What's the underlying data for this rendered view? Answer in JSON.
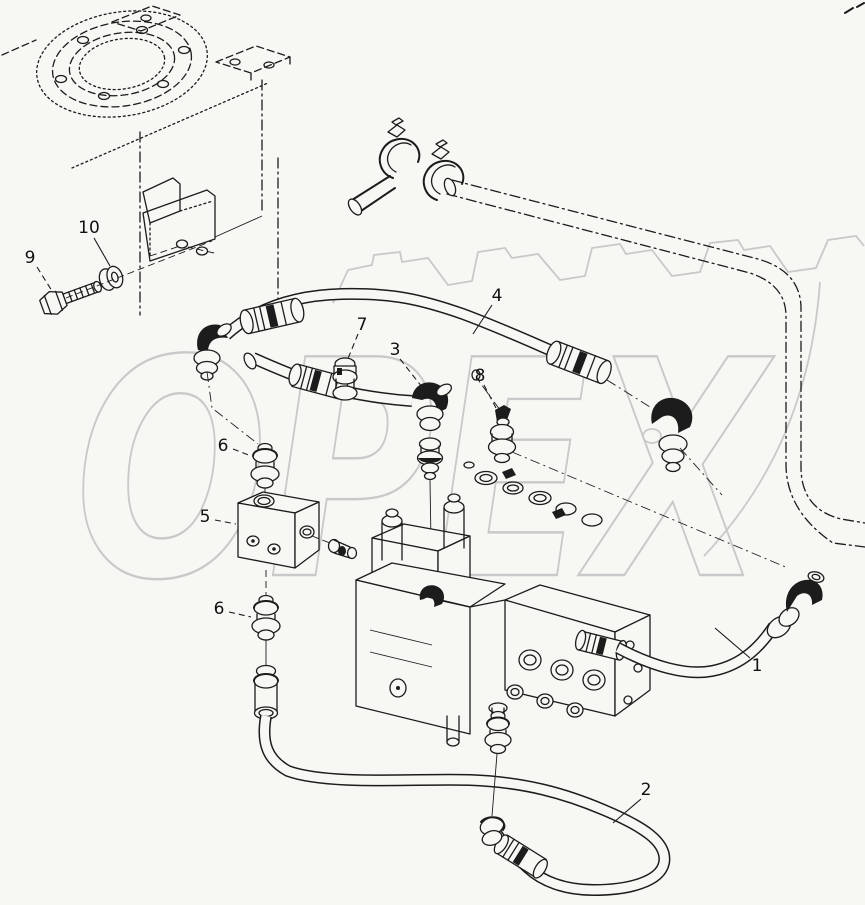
{
  "page": {
    "width": 865,
    "height": 905,
    "background": "#f7f7f4"
  },
  "diagram": {
    "type": "exploded-parts-diagram",
    "ink": "#1c1c1c",
    "watermark": {
      "text": "OPEX",
      "color": "#c9c9c9"
    },
    "callouts": [
      {
        "part": "9",
        "x": 30,
        "y": 258,
        "lx1": 37,
        "ly1": 267,
        "lx2": 52,
        "ly2": 291,
        "dash": true
      },
      {
        "part": "10",
        "x": 89,
        "y": 228,
        "lx1": 94,
        "ly1": 238,
        "lx2": 110,
        "ly2": 266,
        "dash": false
      },
      {
        "part": "4",
        "x": 497,
        "y": 296,
        "lx1": 492,
        "ly1": 305,
        "lx2": 473,
        "ly2": 334,
        "dash": false
      },
      {
        "part": "7",
        "x": 362,
        "y": 325,
        "lx1": 358,
        "ly1": 334,
        "lx2": 347,
        "ly2": 361,
        "dash": true
      },
      {
        "part": "3",
        "x": 395,
        "y": 350,
        "lx1": 400,
        "ly1": 359,
        "lx2": 422,
        "ly2": 387,
        "dash": true
      },
      {
        "part": "8",
        "x": 480,
        "y": 376,
        "lx1": 484,
        "ly1": 385,
        "lx2": 496,
        "ly2": 408,
        "dash": true
      },
      {
        "part": "6",
        "x": 223,
        "y": 446,
        "lx1": 233,
        "ly1": 449,
        "lx2": 251,
        "ly2": 456,
        "dash": true
      },
      {
        "part": "5",
        "x": 205,
        "y": 517,
        "lx1": 215,
        "ly1": 520,
        "lx2": 236,
        "ly2": 524,
        "dash": true
      },
      {
        "part": "6",
        "x": 219,
        "y": 609,
        "lx1": 229,
        "ly1": 612,
        "lx2": 251,
        "ly2": 617,
        "dash": true
      },
      {
        "part": "1",
        "x": 757,
        "y": 666,
        "lx1": 750,
        "ly1": 658,
        "lx2": 715,
        "ly2": 628,
        "dash": false
      },
      {
        "part": "2",
        "x": 646,
        "y": 790,
        "lx1": 641,
        "ly1": 799,
        "lx2": 613,
        "ly2": 823,
        "dash": false
      }
    ]
  }
}
